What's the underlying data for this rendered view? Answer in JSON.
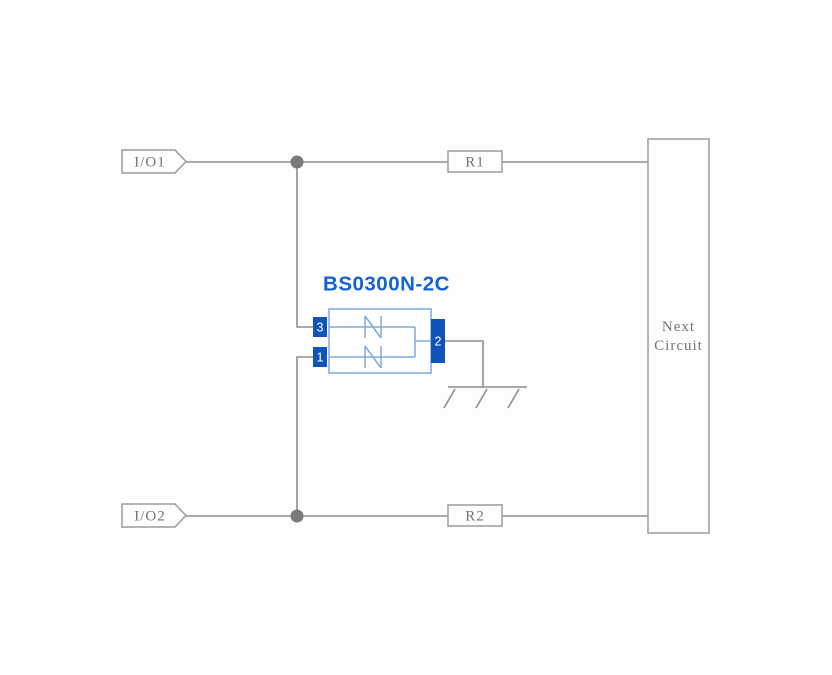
{
  "diagram": {
    "io_tags": {
      "io1": "I/O1",
      "io2": "I/O2"
    },
    "resistors": {
      "r1": "R1",
      "r2": "R2"
    },
    "next_circuit": {
      "line1": "Next",
      "line2": "Circuit"
    },
    "component": {
      "title": "BS0300N-2C",
      "pin3": "3",
      "pin1": "1",
      "pin2": "2"
    },
    "colors": {
      "background": "#fdfdfd",
      "wire_gray": "#8e8e8e",
      "label_gray": "#757575",
      "junction_gray": "#7a7a7a",
      "component_deep_blue": "#0f54bc",
      "component_light_blue": "#7fa9dc",
      "title_blue": "#1463d5"
    }
  }
}
